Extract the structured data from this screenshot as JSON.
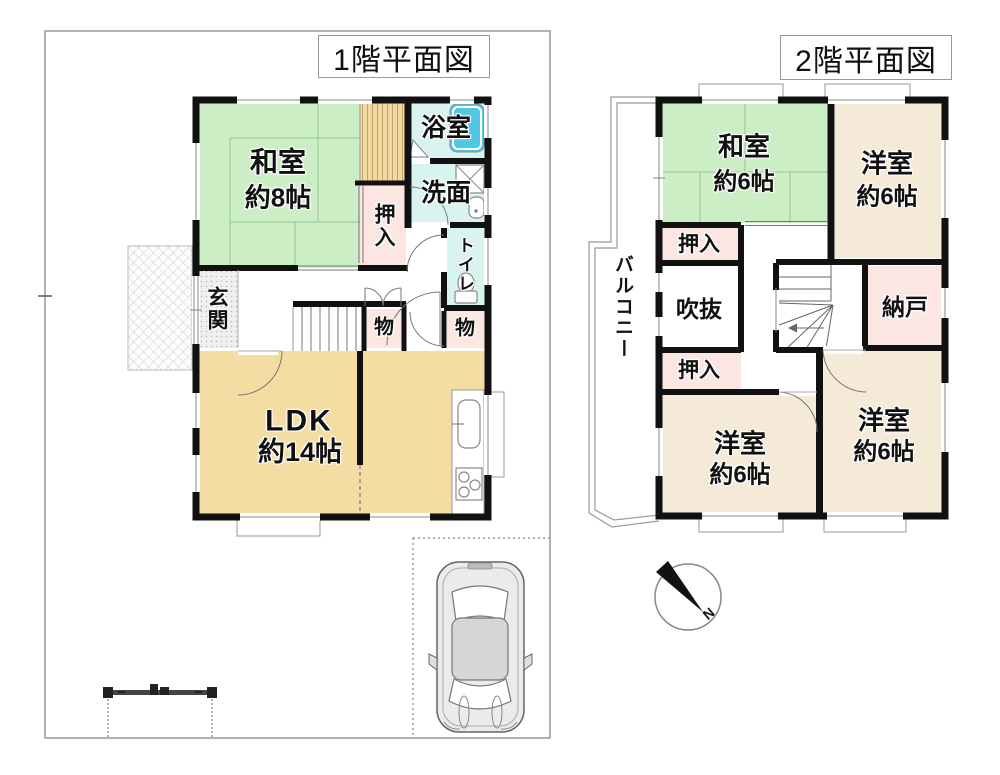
{
  "floor1": {
    "title": "1階平面図",
    "rooms": {
      "washitsu": {
        "name": "和室",
        "size": "約8帖"
      },
      "bathroom": {
        "name": "浴室"
      },
      "washroom": {
        "name": "洗面"
      },
      "toilet": {
        "name": "トイレ"
      },
      "oshiire": {
        "name": "押入"
      },
      "genkan": {
        "name": "玄関"
      },
      "storage_mid": {
        "name": "物"
      },
      "storage_right": {
        "name": "物"
      },
      "ldk": {
        "name": "LDK",
        "size": "約14帖"
      }
    }
  },
  "floor2": {
    "title": "2階平面図",
    "rooms": {
      "washitsu": {
        "name": "和室",
        "size": "約6帖"
      },
      "youshitsu_ne": {
        "name": "洋室",
        "size": "約6帖"
      },
      "oshiire_upper": {
        "name": "押入"
      },
      "fukinuke": {
        "name": "吹抜"
      },
      "oshiire_lower": {
        "name": "押入"
      },
      "nando": {
        "name": "納戸"
      },
      "youshitsu_sw": {
        "name": "洋室",
        "size": "約6帖"
      },
      "youshitsu_se": {
        "name": "洋室",
        "size": "約6帖"
      },
      "balcony": {
        "name": "バルコニー"
      }
    }
  },
  "compass": {
    "north_label": "N"
  },
  "colors": {
    "tatami_green": "#cbeec5",
    "wood_tan": "#f0d9a2",
    "ldk_beige": "#f3dda3",
    "room_cream": "#f5ead7",
    "closet_pink": "#fbe6e2",
    "wet_area_blue": "#d8f3f0",
    "bathtub_blue": "#4fc7e6",
    "wall_black": "#111111",
    "site_line_gray": "#999999"
  }
}
